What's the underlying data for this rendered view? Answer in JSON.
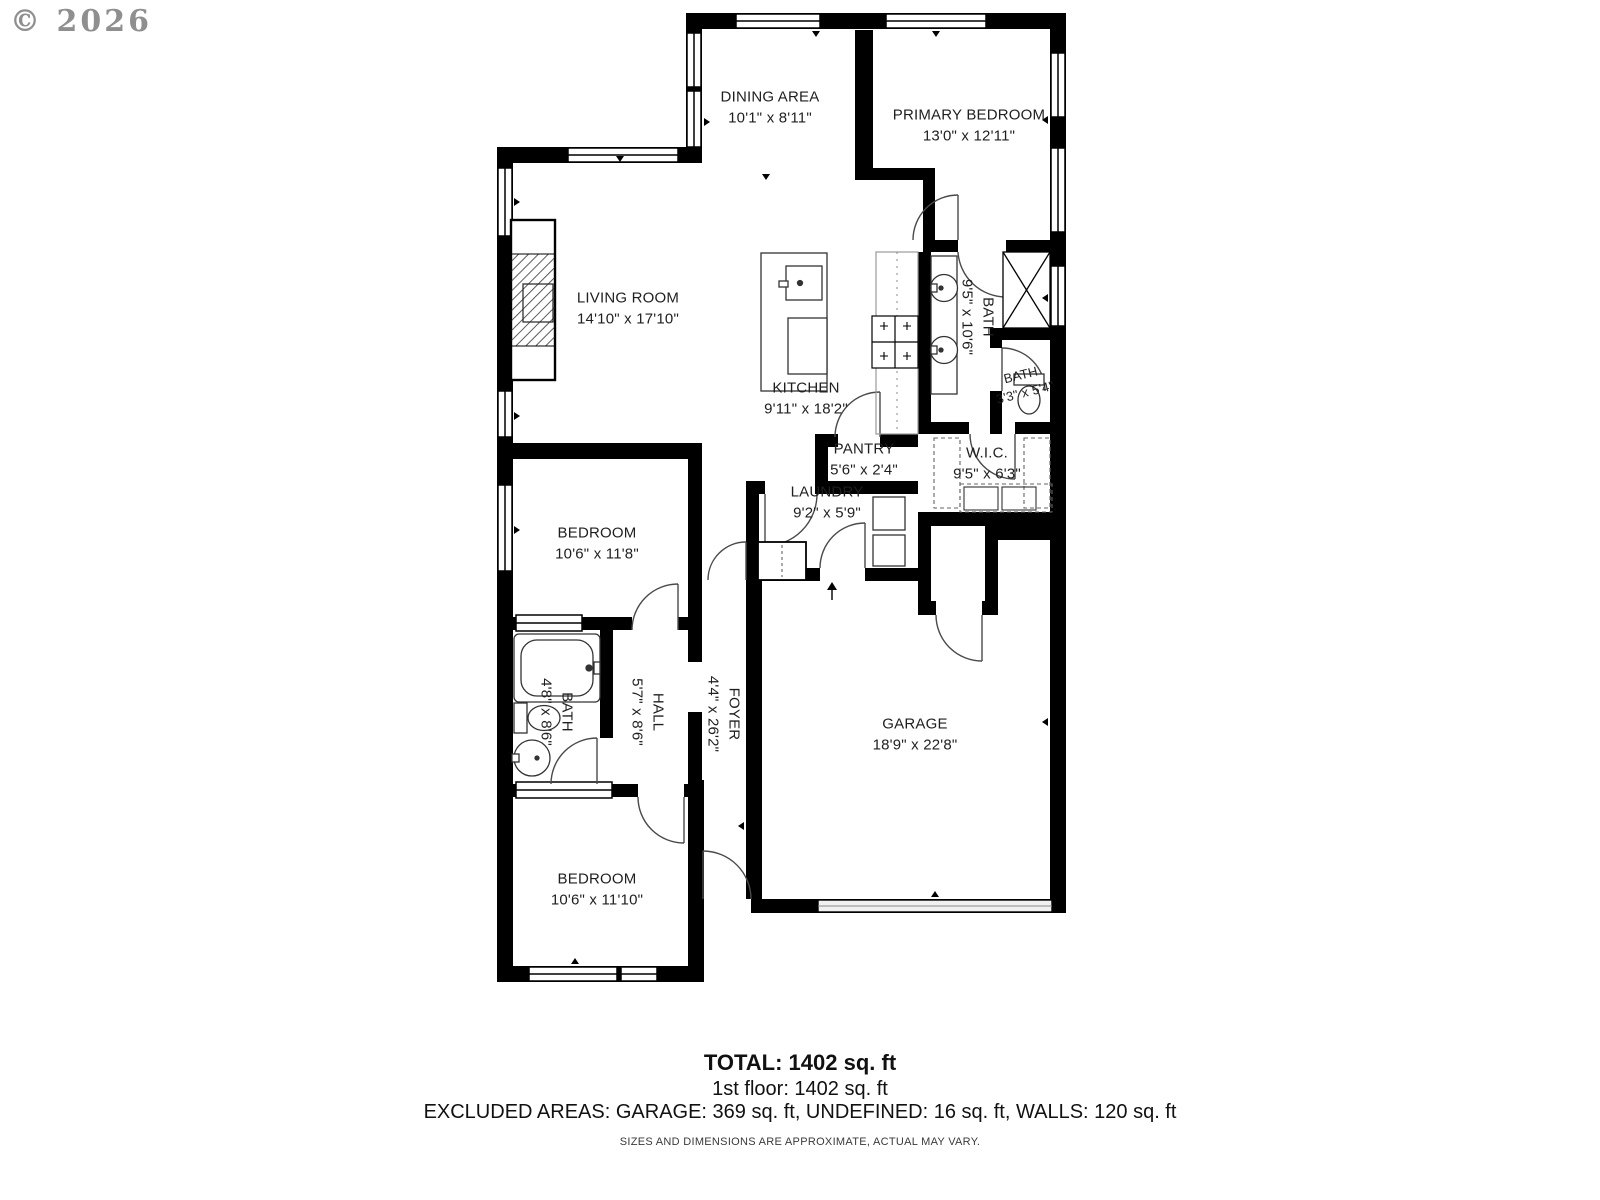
{
  "watermark": "© 2026",
  "plan": {
    "rooms": [
      {
        "id": "dining",
        "name": "DINING AREA",
        "dims": "10'1\" x 8'11\""
      },
      {
        "id": "primary-bedroom",
        "name": "PRIMARY BEDROOM",
        "dims": "13'0\" x 12'11\""
      },
      {
        "id": "living-room",
        "name": "LIVING ROOM",
        "dims": "14'10\" x 17'10\""
      },
      {
        "id": "kitchen",
        "name": "KITCHEN",
        "dims": "9'11\" x 18'2\""
      },
      {
        "id": "primary-bath",
        "name": "BATH",
        "dims": "9'5\" x 10'6\""
      },
      {
        "id": "small-bath",
        "name": "BATH",
        "dims": "3'3\" x 5'4\""
      },
      {
        "id": "pantry",
        "name": "PANTRY",
        "dims": "5'6\" x 2'4\""
      },
      {
        "id": "walk-in-closet",
        "name": "W.I.C.",
        "dims": "9'5\" x 6'3\""
      },
      {
        "id": "laundry",
        "name": "LAUNDRY",
        "dims": "9'2\" x 5'9\""
      },
      {
        "id": "bedroom-1",
        "name": "BEDROOM",
        "dims": "10'6\" x 11'8\""
      },
      {
        "id": "hall-bath",
        "name": "BATH",
        "dims": "4'8\" x 8'6\""
      },
      {
        "id": "hall",
        "name": "HALL",
        "dims": "5'7\" x 8'6\""
      },
      {
        "id": "foyer",
        "name": "FOYER",
        "dims": "4'4\" x 26'2\""
      },
      {
        "id": "garage",
        "name": "GARAGE",
        "dims": "18'9\" x 22'8\""
      },
      {
        "id": "bedroom-2",
        "name": "BEDROOM",
        "dims": "10'6\" x 11'10\""
      }
    ],
    "fixtures": [
      "fireplace",
      "kitchen-island",
      "kitchen-sink",
      "dishwasher",
      "stove",
      "bathroom-sink",
      "shower",
      "toilet",
      "bathtub",
      "washer-dryer",
      "closet-shelves",
      "garage-door",
      "entry-arrow"
    ]
  },
  "summary": {
    "total": "TOTAL: 1402 sq. ft",
    "first_floor": "1st floor: 1402 sq. ft",
    "excluded": "EXCLUDED AREAS: GARAGE: 369 sq. ft, UNDEFINED: 16 sq. ft, WALLS: 120 sq. ft",
    "disclaimer": "SIZES AND DIMENSIONS ARE APPROXIMATE, ACTUAL MAY VARY."
  },
  "colors": {
    "wall": "#000000",
    "label_text": "#1f1f1f",
    "watermark": "#8f8f8f"
  }
}
